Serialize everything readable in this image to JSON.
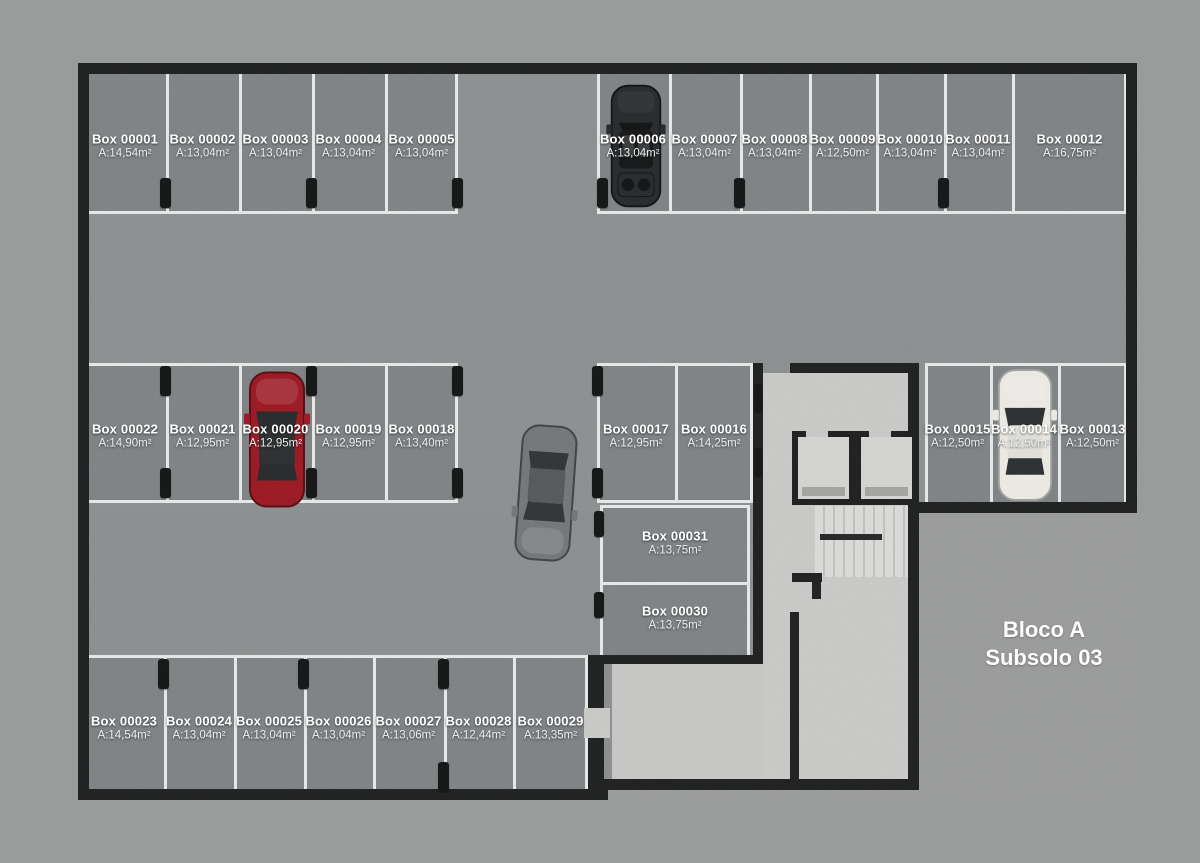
{
  "plan": {
    "title_line1": "Bloco A",
    "title_line2": "Subsolo 03"
  },
  "colors": {
    "background": "#9a9b9b",
    "aisle_floor": "#8c8f90",
    "box_floor": "#7e8284",
    "wall": "#1d1e1e",
    "marking_line": "#e7e8e8",
    "core_floor": "#c9c9c7",
    "label_text": "#ffffff",
    "car_red": "#9b1622",
    "car_white": "#eceae5",
    "car_gray": "#737678",
    "car_black": "#26282a"
  },
  "boxes": [
    {
      "label": "Box 00001",
      "area": "A:14,54m²"
    },
    {
      "label": "Box 00002",
      "area": "A:13,04m²"
    },
    {
      "label": "Box 00003",
      "area": "A:13,04m²"
    },
    {
      "label": "Box 00004",
      "area": "A:13,04m²"
    },
    {
      "label": "Box 00005",
      "area": "A:13,04m²"
    },
    {
      "label": "Box 00006",
      "area": "A:13,04m²"
    },
    {
      "label": "Box 00007",
      "area": "A:13,04m²"
    },
    {
      "label": "Box 00008",
      "area": "A:13,04m²"
    },
    {
      "label": "Box 00009",
      "area": "A:12,50m²"
    },
    {
      "label": "Box 00010",
      "area": "A:13,04m²"
    },
    {
      "label": "Box 00011",
      "area": "A:13,04m²"
    },
    {
      "label": "Box 00012",
      "area": "A:16,75m²"
    },
    {
      "label": "Box 00013",
      "area": "A:12,50m²"
    },
    {
      "label": "Box 00014",
      "area": "A:12,50m²"
    },
    {
      "label": "Box 00015",
      "area": "A:12,50m²"
    },
    {
      "label": "Box 00016",
      "area": "A:14,25m²"
    },
    {
      "label": "Box 00017",
      "area": "A:12,95m²"
    },
    {
      "label": "Box 00018",
      "area": "A:13,40m²"
    },
    {
      "label": "Box 00019",
      "area": "A:12,95m²"
    },
    {
      "label": "Box 00020",
      "area": "A:12,95m²"
    },
    {
      "label": "Box 00021",
      "area": "A:12,95m²"
    },
    {
      "label": "Box 00022",
      "area": "A:14,90m²"
    },
    {
      "label": "Box 00023",
      "area": "A:14,54m²"
    },
    {
      "label": "Box 00024",
      "area": "A:13,04m²"
    },
    {
      "label": "Box 00025",
      "area": "A:13,04m²"
    },
    {
      "label": "Box 00026",
      "area": "A:13,04m²"
    },
    {
      "label": "Box 00027",
      "area": "A:13,06m²"
    },
    {
      "label": "Box 00028",
      "area": "A:12,44m²"
    },
    {
      "label": "Box 00029",
      "area": "A:13,35m²"
    },
    {
      "label": "Box 00030",
      "area": "A:13,75m²"
    },
    {
      "label": "Box 00031",
      "area": "A:13,75m²"
    }
  ]
}
